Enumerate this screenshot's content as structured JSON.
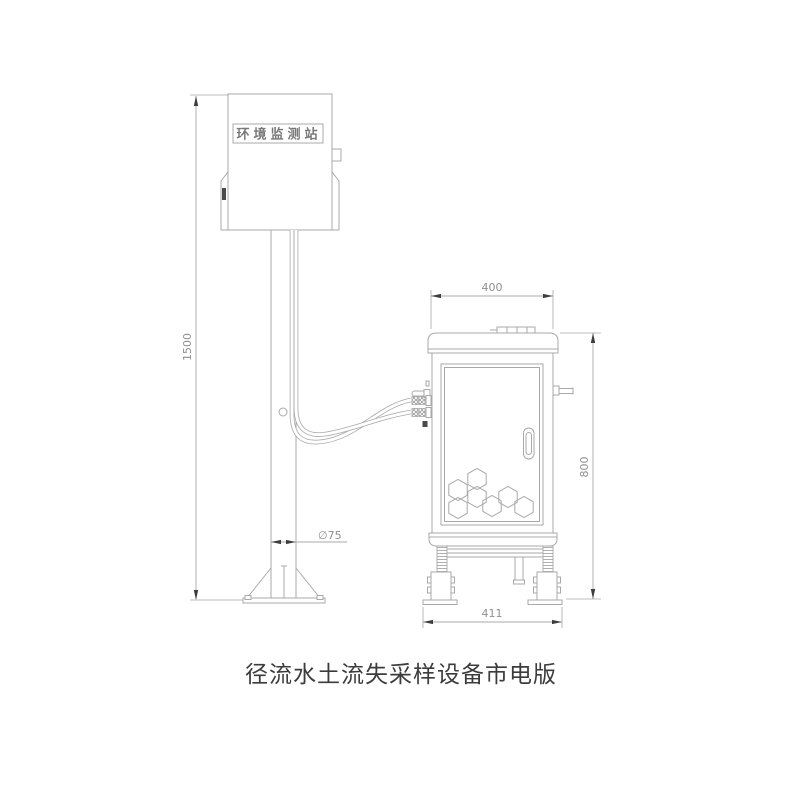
{
  "drawing": {
    "title": "径流水土流失采样设备市电版",
    "station_label": "环境监测站",
    "dims": {
      "pole_height": "1500",
      "pole_diameter": "∅75",
      "cabinet_width": "400",
      "cabinet_height": "800",
      "base_width": "411"
    }
  },
  "colors": {
    "line": "#a9a9a9",
    "dim_text": "#8f8f8f",
    "arrow": "#3d3d3d",
    "text": "#3c3c3c"
  }
}
